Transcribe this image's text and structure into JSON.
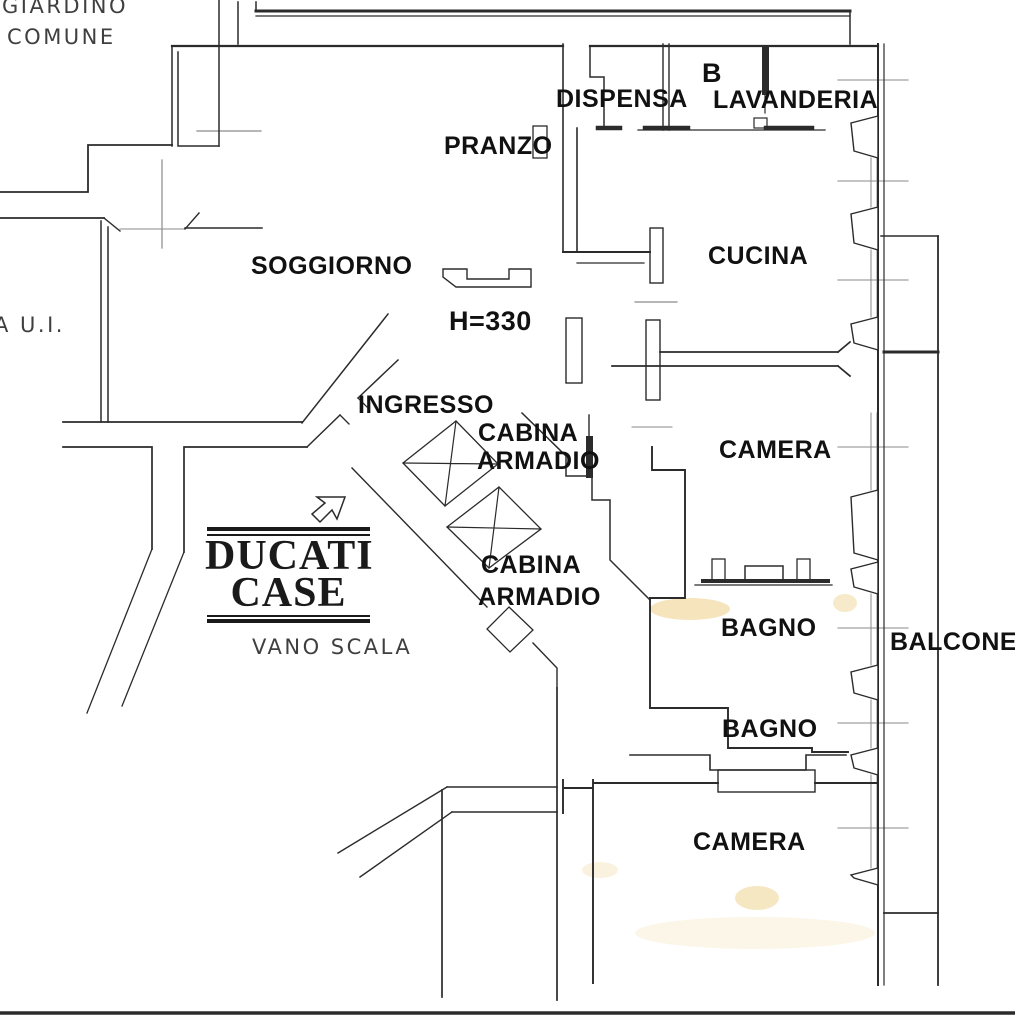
{
  "plan_title": "apartment-floor-plan",
  "labels": {
    "giardino_line1": "GIARDINO",
    "giardino_line2": "COMUNE",
    "unit_ref": "A U.I.",
    "dispensa": "DISPENSA",
    "boiler": "B",
    "lavanderia": "LAVANDERIA",
    "pranzo": "PRANZO",
    "soggiorno": "SOGGIORNO",
    "ceiling_height": "H=330",
    "cucina": "CUCINA",
    "ingresso": "INGRESSO",
    "cabina_armadio_1_line1": "CABINA",
    "cabina_armadio_1_line2": "ARMADIO",
    "camera_1": "CAMERA",
    "cabina_armadio_2_line1": "CABINA",
    "cabina_armadio_2_line2": "ARMADIO",
    "bagno_1": "BAGNO",
    "balcone": "BALCONE",
    "vano_scala": "VANO SCALA",
    "bagno_2": "BAGNO",
    "camera_2": "CAMERA"
  },
  "watermark": {
    "line1": "DUCATI",
    "line2": "CASE"
  },
  "colors": {
    "wall_line": "#2b2b2b",
    "thin_line": "#8a8a8a",
    "text": "#111111",
    "cad_text": "#3f3f3f",
    "highlight": "#e9c36a",
    "background": "#ffffff"
  }
}
